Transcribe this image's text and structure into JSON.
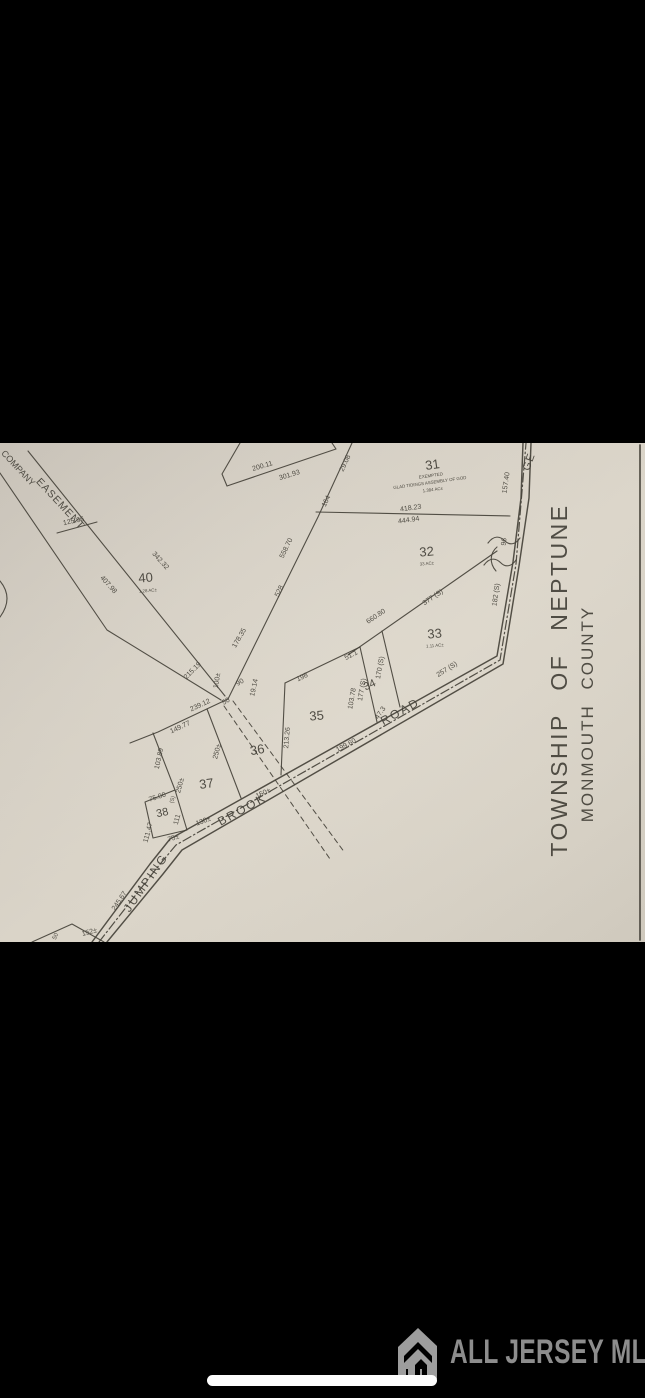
{
  "viewer": {
    "description": "photo of tax plat map on black background",
    "home_indicator": true
  },
  "colors": {
    "background": "#000000",
    "ink": "#45423a",
    "paper_light": "#dbd5c9",
    "paper_dark": "#c8c2b8",
    "watermark_gray": "#8d8d8d",
    "indicator_white": "#fdfdfd"
  },
  "watermark": {
    "icon": "building-icon",
    "text": "ALL JERSEY MLS"
  },
  "map": {
    "township": "TOWNSHIP OF NEPTUNE",
    "county": "MONMOUTH COUNTY",
    "road_name": "JUMPING BROOK ROAD",
    "labels": [
      {
        "id": "lot-31-number",
        "t": "31",
        "x": 433,
        "y": 26,
        "r": -8,
        "s": 13
      },
      {
        "id": "lot-31-note-exempted",
        "t": "EXEMPTED",
        "x": 431,
        "y": 34,
        "r": -8,
        "s": 4.4
      },
      {
        "id": "lot-31-owner",
        "t": "GLAD TIDINGS ASSEMBLY OF GOD",
        "x": 430,
        "y": 41,
        "r": -8,
        "s": 4.4
      },
      {
        "id": "lot-31-area",
        "t": "1.384 AC±",
        "x": 433,
        "y": 48,
        "r": -8,
        "s": 4.4
      },
      {
        "id": "lot-32-number",
        "t": "32",
        "x": 427,
        "y": 113,
        "r": -5,
        "s": 13
      },
      {
        "id": "lot-32-area",
        "t": "33 AC±",
        "x": 427,
        "y": 122,
        "r": -5,
        "s": 4.4
      },
      {
        "id": "lot-33-number",
        "t": "33",
        "x": 435,
        "y": 195,
        "r": -5,
        "s": 13
      },
      {
        "id": "lot-33-area",
        "t": "1.11 AC±",
        "x": 435,
        "y": 204,
        "r": -5,
        "s": 4.4
      },
      {
        "id": "lot-34-number",
        "t": "34",
        "x": 371,
        "y": 245,
        "r": -25,
        "s": 11
      },
      {
        "id": "lot-35-number",
        "t": "35",
        "x": 317,
        "y": 277,
        "r": -5,
        "s": 13
      },
      {
        "id": "lot-36-number",
        "t": "36",
        "x": 258,
        "y": 311,
        "r": -10,
        "s": 13
      },
      {
        "id": "lot-37-number",
        "t": "37",
        "x": 207,
        "y": 345,
        "r": -8,
        "s": 13
      },
      {
        "id": "lot-38-number",
        "t": "38",
        "x": 163,
        "y": 373,
        "r": -12,
        "s": 11
      },
      {
        "id": "lot-40-number",
        "t": "40",
        "x": 146,
        "y": 139,
        "r": -5,
        "s": 13
      },
      {
        "id": "lot-40-area",
        "t": "1.28 AC±",
        "x": 148,
        "y": 149,
        "r": -5,
        "s": 4.4
      },
      {
        "id": "dim-200-11",
        "t": "200.11",
        "x": 263,
        "y": 25,
        "r": -17
      },
      {
        "id": "dim-301-93",
        "t": "301.93",
        "x": 290,
        "y": 34,
        "r": -17
      },
      {
        "id": "dim-29-08",
        "t": "29.08",
        "x": 347,
        "y": 21,
        "r": -65
      },
      {
        "id": "dim-164",
        "t": "164",
        "x": 328,
        "y": 59,
        "r": -65
      },
      {
        "id": "dim-558-70",
        "t": "558.70",
        "x": 288,
        "y": 106,
        "r": -64
      },
      {
        "id": "dim-528",
        "t": "528",
        "x": 281,
        "y": 149,
        "r": -64
      },
      {
        "id": "dim-178-35",
        "t": "178.35",
        "x": 241,
        "y": 196,
        "r": -60
      },
      {
        "id": "dim-215-19",
        "t": "215.19",
        "x": 194,
        "y": 229,
        "r": -45
      },
      {
        "id": "dim-100",
        "t": "100±",
        "x": 219,
        "y": 238,
        "r": -80
      },
      {
        "id": "dim-50",
        "t": "50",
        "x": 227,
        "y": 260,
        "r": -30
      },
      {
        "id": "dim-90",
        "t": "90",
        "x": 241,
        "y": 241,
        "r": -30
      },
      {
        "id": "dim-19-14",
        "t": "19.14",
        "x": 256,
        "y": 245,
        "r": -78
      },
      {
        "id": "dim-239-12",
        "t": "239.12",
        "x": 201,
        "y": 264,
        "r": -25
      },
      {
        "id": "dim-149-77",
        "t": "149.77",
        "x": 181,
        "y": 286,
        "r": -25
      },
      {
        "id": "dim-103-89",
        "t": "103.89",
        "x": 161,
        "y": 316,
        "r": -78
      },
      {
        "id": "dim-250-a",
        "t": "250±",
        "x": 219,
        "y": 309,
        "r": -75
      },
      {
        "id": "dim-250-b",
        "t": "250±",
        "x": 182,
        "y": 343,
        "r": -75
      },
      {
        "id": "dim-75-00",
        "t": "75.00",
        "x": 158,
        "y": 356,
        "r": -18
      },
      {
        "id": "dim-s-mark",
        "t": "(S)",
        "x": 174,
        "y": 357,
        "r": -75,
        "s": 5.5
      },
      {
        "id": "dim-111",
        "t": "111",
        "x": 179,
        "y": 377,
        "r": -75
      },
      {
        "id": "dim-111-47",
        "t": "111.47",
        "x": 150,
        "y": 390,
        "r": -75
      },
      {
        "id": "dim-75",
        "t": "75±",
        "x": 174,
        "y": 397,
        "r": -18
      },
      {
        "id": "dim-130",
        "t": "130±",
        "x": 204,
        "y": 380,
        "r": -21
      },
      {
        "id": "dim-150",
        "t": "150±",
        "x": 264,
        "y": 352,
        "r": -25
      },
      {
        "id": "dim-245-67",
        "t": "245.67",
        "x": 121,
        "y": 459,
        "r": -56
      },
      {
        "id": "dim-152",
        "t": "152±",
        "x": 90,
        "y": 491,
        "r": -15
      },
      {
        "id": "dim-tri-50",
        "t": "50",
        "x": 57,
        "y": 494,
        "r": -65,
        "s": 6
      },
      {
        "id": "dim-198",
        "t": "198",
        "x": 303,
        "y": 236,
        "r": -25
      },
      {
        "id": "dim-213-26",
        "t": "213.26",
        "x": 289,
        "y": 295,
        "r": -85
      },
      {
        "id": "dim-199-60",
        "t": "199.60",
        "x": 347,
        "y": 304,
        "r": -28
      },
      {
        "id": "dim-51-1",
        "t": "51.1",
        "x": 352,
        "y": 214,
        "r": -27
      },
      {
        "id": "dim-103-78",
        "t": "103.78",
        "x": 354,
        "y": 256,
        "r": -80
      },
      {
        "id": "dim-177-s",
        "t": "177 (S)",
        "x": 364,
        "y": 247,
        "r": -80
      },
      {
        "id": "dim-170-s",
        "t": "170 (S)",
        "x": 382,
        "y": 225,
        "r": -80
      },
      {
        "id": "dim-47-3",
        "t": "47.3",
        "x": 382,
        "y": 271,
        "r": -55
      },
      {
        "id": "dim-660-80",
        "t": "660.80",
        "x": 377,
        "y": 175,
        "r": -34
      },
      {
        "id": "dim-377-s",
        "t": "377 (S)",
        "x": 434,
        "y": 156,
        "r": -34
      },
      {
        "id": "dim-257-s",
        "t": "257 (S)",
        "x": 448,
        "y": 228,
        "r": -32
      },
      {
        "id": "dim-182-s",
        "t": "182 (S)",
        "x": 498,
        "y": 152,
        "r": -82
      },
      {
        "id": "dim-96",
        "t": "96",
        "x": 506,
        "y": 99,
        "r": -82
      },
      {
        "id": "dim-157-40",
        "t": "157.40",
        "x": 508,
        "y": 40,
        "r": -82
      },
      {
        "id": "dim-418-23",
        "t": "418.23",
        "x": 411,
        "y": 67,
        "r": -8
      },
      {
        "id": "dim-444-94",
        "t": "444.94",
        "x": 409,
        "y": 79,
        "r": -8
      },
      {
        "id": "dim-342-32",
        "t": "342.32",
        "x": 159,
        "y": 119,
        "r": 48
      },
      {
        "id": "dim-407-98",
        "t": "407.98",
        "x": 107,
        "y": 143,
        "r": 48
      },
      {
        "id": "dim-125-96",
        "t": "125.96",
        "x": 74,
        "y": 80,
        "r": -12
      },
      {
        "id": "name-company",
        "t": "COMPANY",
        "x": 16,
        "y": 27,
        "r": 47,
        "s": 9
      },
      {
        "id": "name-easement",
        "t": "EASEMENT",
        "x": 58,
        "y": 63,
        "r": 47,
        "s": 10.5,
        "ls": 1
      },
      {
        "id": "name-jumping",
        "t": "JUMPING",
        "x": 149,
        "y": 442,
        "r": -55,
        "s": 12,
        "ls": 2
      },
      {
        "id": "name-brook",
        "t": "BROOK",
        "x": 244,
        "y": 370,
        "r": -29,
        "s": 12,
        "ls": 2
      },
      {
        "id": "name-road",
        "t": "ROAD",
        "x": 402,
        "y": 272,
        "r": -29,
        "s": 12,
        "ls": 2
      },
      {
        "id": "name-ge",
        "t": "GE",
        "x": 532,
        "y": 20,
        "r": -70,
        "s": 11,
        "ls": 1
      },
      {
        "id": "township-title",
        "t": "TOWNSHIP OF NEPTUNE",
        "x": 567,
        "y": 237,
        "r": -90,
        "s": 23,
        "ws": 14,
        "ls": 2.5
      },
      {
        "id": "county-title",
        "t": "MONMOUTH COUNTY",
        "x": 593,
        "y": 271,
        "r": -90,
        "s": 17,
        "ws": 8,
        "ls": 2
      }
    ]
  }
}
